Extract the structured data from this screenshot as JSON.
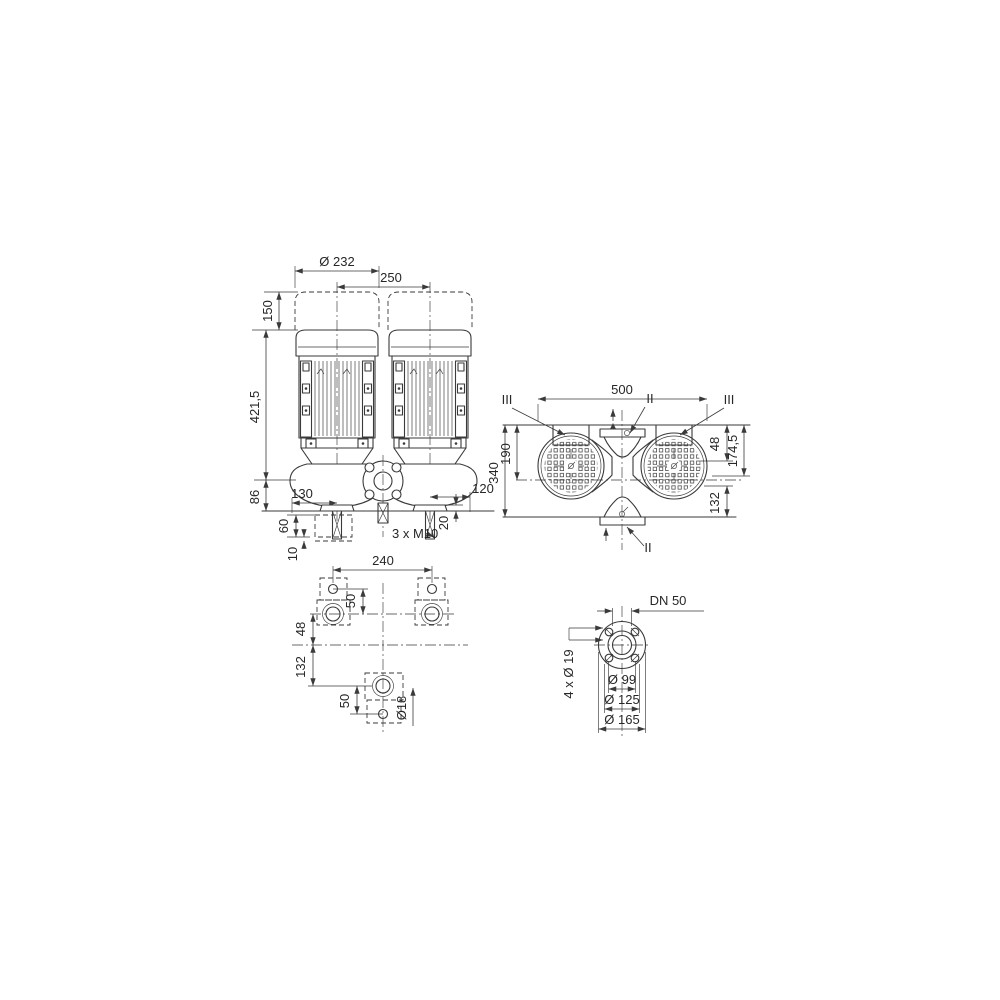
{
  "page": {
    "background": "#ffffff",
    "line_color": "#3a3a3a"
  },
  "front_view": {
    "motor_diameter": "Ø 232",
    "motor_spacing": "250",
    "clearance_height": "150",
    "height_axis_to_top": "421,5",
    "base_to_axis": "86",
    "axis_to_left": "130",
    "axis_to_right": "120",
    "pad_height": "60",
    "pad_shim": "10",
    "foot_thickness": "20",
    "stud_spec": "3 x M10"
  },
  "top_view": {
    "overall_width": "500",
    "edge_to_motor_axis": "190",
    "overall_depth": "340",
    "motor_axis_offset": "48",
    "edge_to_center": "174,5",
    "center_to_rear": "132",
    "marker_iii_left": "III",
    "marker_ii_top": "II",
    "marker_iii_right": "III",
    "marker_ii_bottom": "II"
  },
  "foot_plan": {
    "bolt_spacing": "240",
    "front_hole_offset": "50",
    "feet_axis_to_center": "48",
    "center_to_rear_foot": "132",
    "rear_hole_offset": "50",
    "bolt_hole_diameter": "Ø18"
  },
  "flange_detail": {
    "nominal_bore": "DN 50",
    "bolt_holes": "4 x Ø 19",
    "raised_face": "Ø 99",
    "bolt_circle": "Ø 125",
    "outer_diameter": "Ø 165"
  }
}
